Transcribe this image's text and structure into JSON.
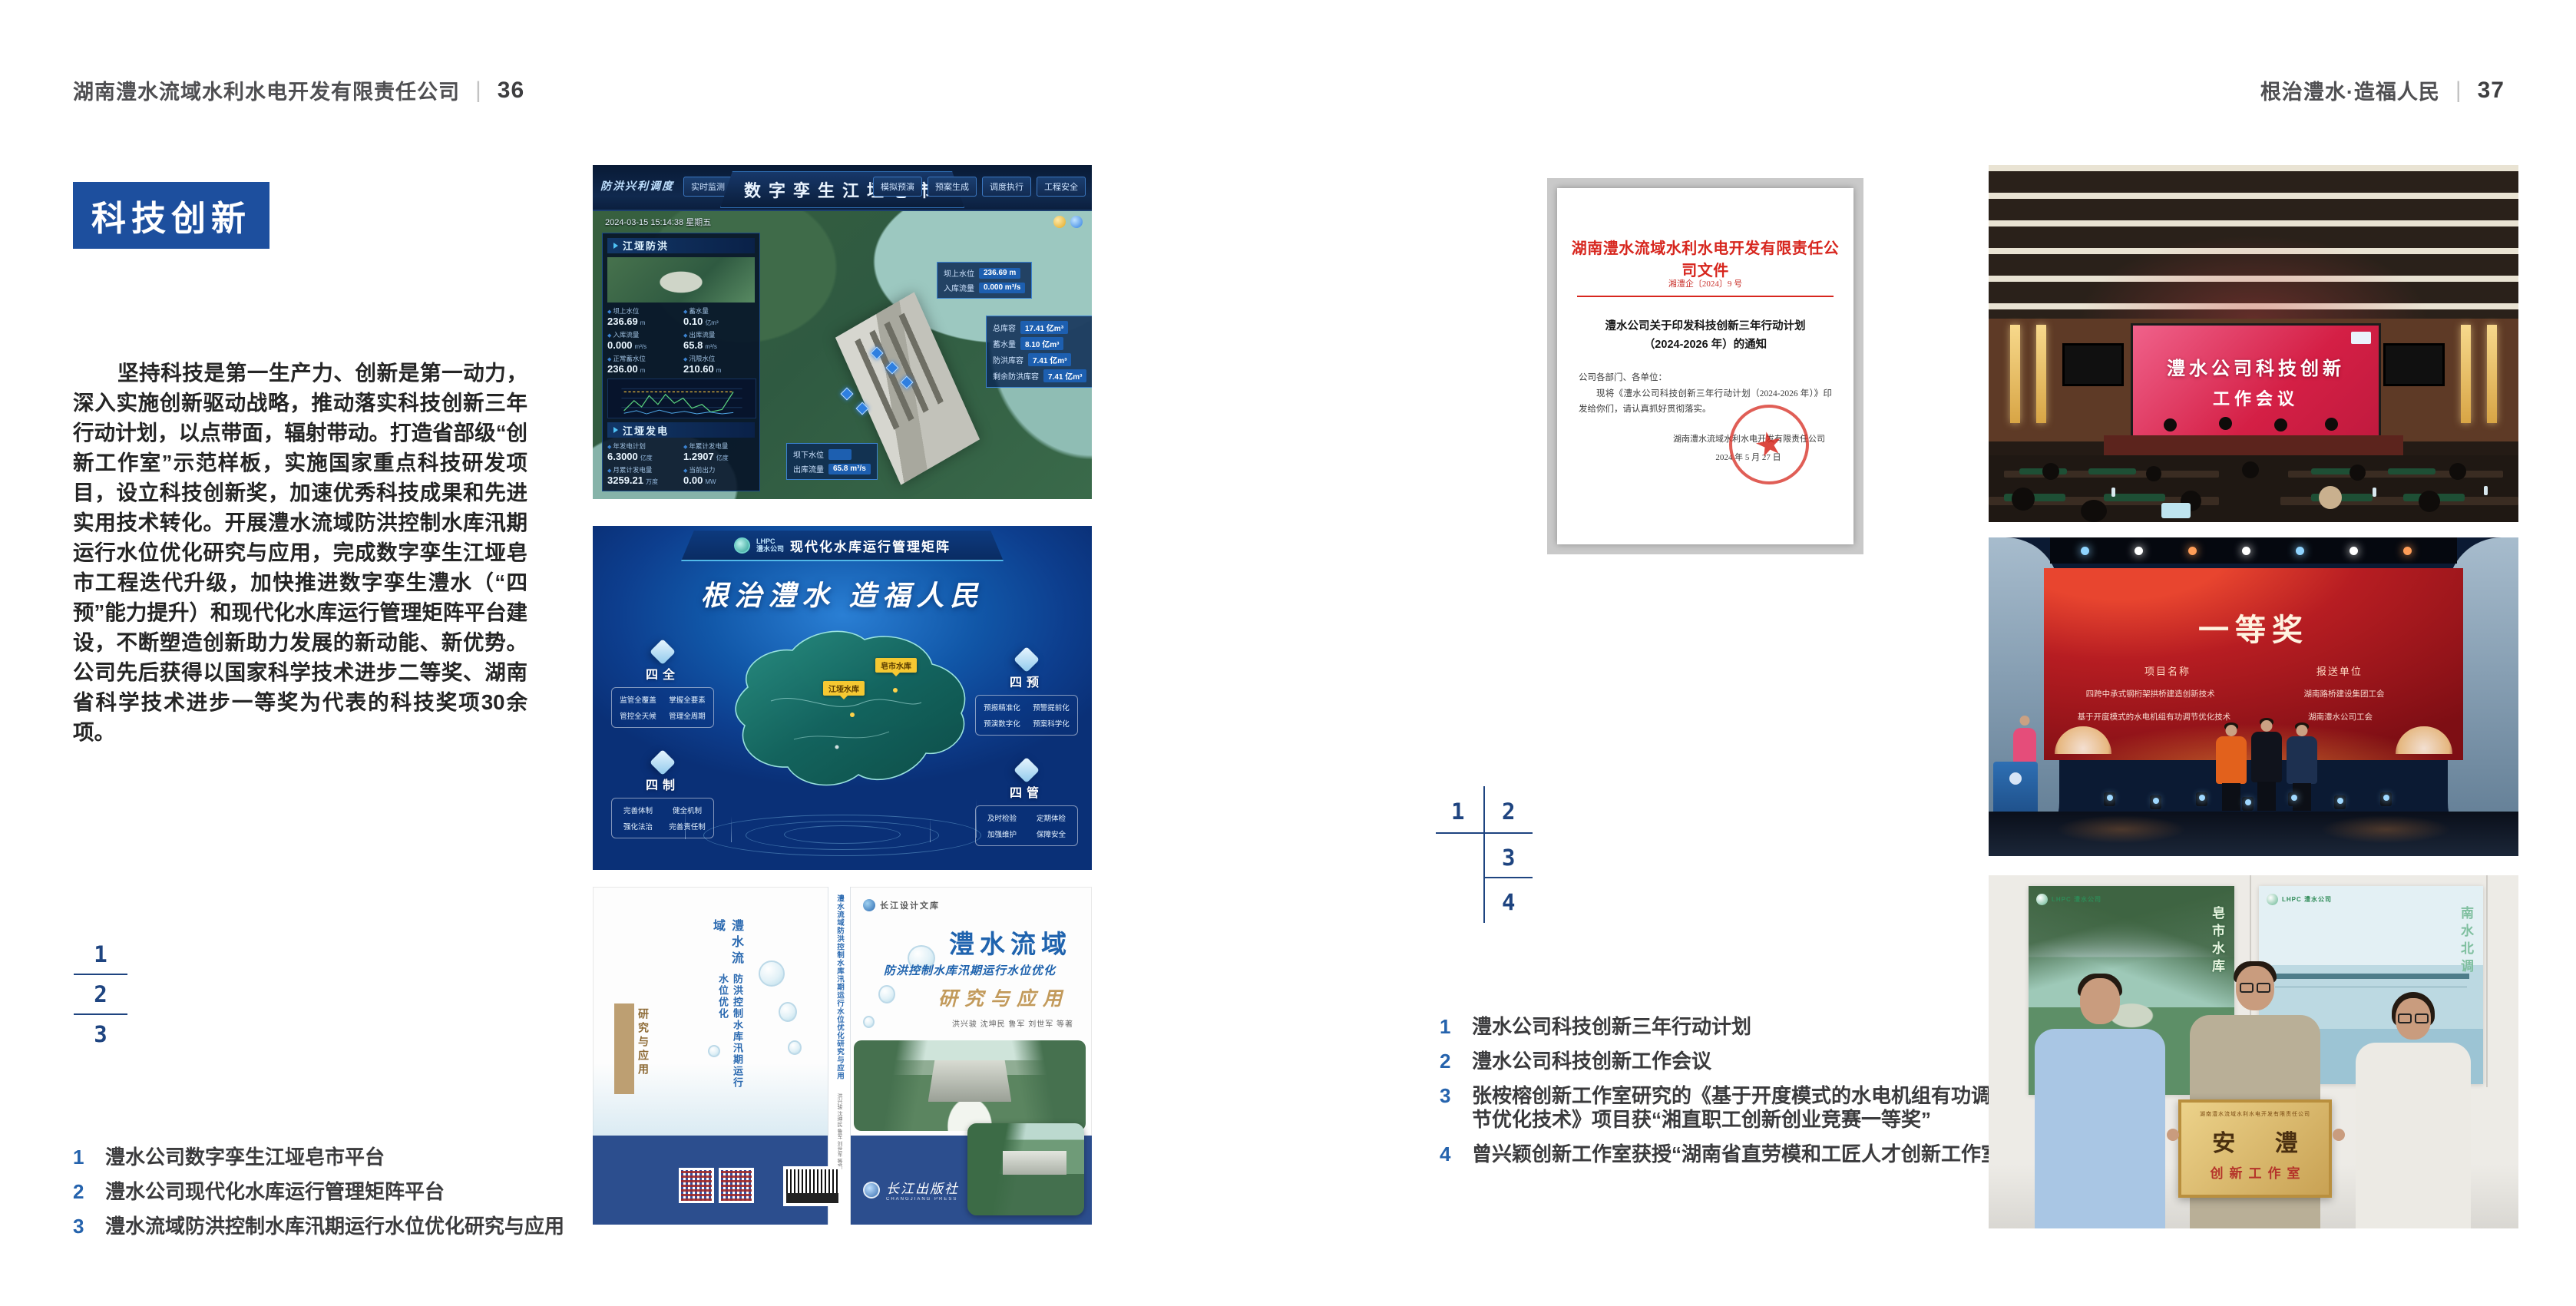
{
  "spread": {
    "left_header": {
      "company": "湖南澧水流域水利水电开发有限责任公司",
      "separator": "|",
      "page_number": "36"
    },
    "right_header": {
      "slogan": "根治澧水·造福人民",
      "separator": "|",
      "page_number": "37"
    },
    "section_title": "科技创新",
    "body_paragraph": "坚持科技是第一生产力、创新是第一动力，深入实施创新驱动战略，推动落实科技创新三年行动计划，以点带面，辐射带动。打造省部级“创新工作室”示范样板，实施国家重点科技研发项目，设立科技创新奖，加速优秀科技成果和先进实用技术转化。开展澧水流域防洪控制水库汛期运行水位优化研究与应用，完成数字孪生江垭皂市工程迭代升级，加快推进数字孪生澧水（“四预”能力提升）和现代化水库运行管理矩阵平台建设，不断塑造创新助力发展的新动能、新优势。公司先后获得以国家科学技术进步二等奖、湖南省科学技术进步一等奖为代表的科技奖项30余项。",
    "left_figure_index": {
      "n1": "1",
      "n2": "2",
      "n3": "3"
    },
    "right_figure_index": {
      "n1": "1",
      "n2": "2",
      "n3": "3",
      "n4": "4"
    },
    "left_captions": [
      {
        "num": "1",
        "text": "澧水公司数字孪生江垭皂市平台"
      },
      {
        "num": "2",
        "text": "澧水公司现代化水库运行管理矩阵平台"
      },
      {
        "num": "3",
        "text": "澧水流域防洪控制水库汛期运行水位优化研究与应用"
      }
    ],
    "right_captions": [
      {
        "num": "1",
        "text": "澧水公司科技创新三年行动计划"
      },
      {
        "num": "2",
        "text": "澧水公司科技创新工作会议"
      },
      {
        "num": "3",
        "text": "张桉榕创新工作室研究的《基于开度模式的水电机组有功调节优化技术》项目获“湘直职工创新创业竞赛一等奖”"
      },
      {
        "num": "4",
        "text": "曾兴颖创新工作室获授“湖南省直劳模和工匠人才创新工作室”"
      }
    ]
  },
  "digital_twin": {
    "title": "数字孪生江垭皂市",
    "brand": "防洪兴利调度",
    "datetime": "2024-03-15 15:14:38 星期五",
    "nav_left": [
      "实时监测",
      "洪水预报",
      "防洪预警"
    ],
    "nav_right": [
      "模拟预演",
      "预案生成",
      "调度执行",
      "工程安全"
    ],
    "panel1_title": "江垭防洪",
    "panel2_title": "江垭发电",
    "stats": [
      {
        "label": "坝上水位",
        "value": "236.69",
        "unit": "m"
      },
      {
        "label": "蓄水量",
        "value": "0.10",
        "unit": "亿m³"
      },
      {
        "label": "入库流量",
        "value": "0.000",
        "unit": "m³/s"
      },
      {
        "label": "出库流量",
        "value": "65.8",
        "unit": "m³/s"
      },
      {
        "label": "正常蓄水位",
        "value": "236.00",
        "unit": "m"
      },
      {
        "label": "汛限水位",
        "value": "210.60",
        "unit": "m"
      }
    ],
    "gen_stats": [
      {
        "label": "年发电计划",
        "value": "6.3000",
        "unit": "亿度"
      },
      {
        "label": "年累计发电量",
        "value": "1.2907",
        "unit": "亿度"
      },
      {
        "label": "月累计发电量",
        "value": "3259.21",
        "unit": "万度"
      },
      {
        "label": "当前出力",
        "value": "0.00",
        "unit": "MW"
      }
    ],
    "callout1": [
      {
        "label": "坝上水位",
        "value": "236.69 m"
      },
      {
        "label": "入库流量",
        "value": "0.000 m³/s"
      }
    ],
    "callout2": [
      {
        "label": "总库容",
        "value": "17.41 亿m³"
      },
      {
        "label": "蓄水量",
        "value": "8.10 亿m³"
      },
      {
        "label": "防洪库容",
        "value": "7.41 亿m³"
      },
      {
        "label": "剩余防洪库容",
        "value": "7.41 亿m³"
      }
    ],
    "callout3": [
      {
        "label": "坝下水位",
        "value": ""
      },
      {
        "label": "出库流量",
        "value": "65.8 m³/s"
      }
    ]
  },
  "matrix": {
    "logo_line1": "LHPC",
    "logo_line2": "澧水公司",
    "title": "现代化水库运行管理矩阵",
    "slogan": "根治澧水 造福人民",
    "panels": [
      {
        "title": "四全",
        "items": [
          "监管全覆盖",
          "掌握全要素",
          "管控全天候",
          "管理全周期"
        ]
      },
      {
        "title": "四预",
        "items": [
          "预报精准化",
          "预警提前化",
          "预演数字化",
          "预案科学化"
        ]
      },
      {
        "title": "四制",
        "items": [
          "完善体制",
          "健全机制",
          "强化法治",
          "完善责任制"
        ]
      },
      {
        "title": "四管",
        "items": [
          "及时检验",
          "定期体检",
          "加强维护",
          "保障安全"
        ]
      }
    ],
    "map_labels": [
      "江垭水库",
      "皂市水库"
    ]
  },
  "book": {
    "series": "长江设计文库",
    "title_main": "澧水流域",
    "title_sub": "防洪控制水库汛期运行水位优化",
    "title_tail": "研究与应用",
    "authors": "洪兴骏 沈坤民 鲁军 刘世军 等著",
    "spine_text": "澧水流域防洪控制水库汛期运行水位优化研究与应用",
    "publisher": "长江出版社",
    "publisher_en": "CHANGJIANG PRESS"
  },
  "document": {
    "letterhead": "湖南澧水流域水利水电开发有限责任公司文件",
    "doc_no": "湘澧企〔2024〕9 号",
    "title_line1": "澧水公司关于印发科技创新三年行动计划",
    "title_line2": "（2024-2026 年）的通知",
    "salutation": "公司各部门、各单位：",
    "body": "现将《澧水公司科技创新三年行动计划（2024-2026 年）》印发给你们，请认真抓好贯彻落实。",
    "signer": "湖南澧水流域水利水电开发有限责任公司",
    "date": "2024 年 5 月 27 日"
  },
  "meeting": {
    "screen_line1": "澧水公司科技创新",
    "screen_line2": "工作会议"
  },
  "award": {
    "title": "一等奖",
    "col1": "项目名称",
    "col2": "报送单位",
    "rows": [
      {
        "project": "四跨中承式钢桁架拱桥建造创新技术",
        "org": "湖南路桥建设集团工会"
      },
      {
        "project": "基于开度模式的水电机组有功调节优化技术",
        "org": "湖南澧水公司工会"
      }
    ]
  },
  "workshop": {
    "plaque_header": "湖南澧水流域水利水电开发有限责任公司",
    "plaque_title": "安 澧",
    "plaque_sub": "创新工作室",
    "poster_left_logo": "LHPC 澧水公司",
    "poster_left_caption": "皂市水库",
    "poster_right_logo": "LHPC 澧水公司",
    "poster_right_caption": "南水北调"
  },
  "colors": {
    "accent_blue": "#1d4f9e",
    "index_navy": "#1e4480",
    "doc_red": "#d7261e",
    "gold": "#c29a5b"
  }
}
